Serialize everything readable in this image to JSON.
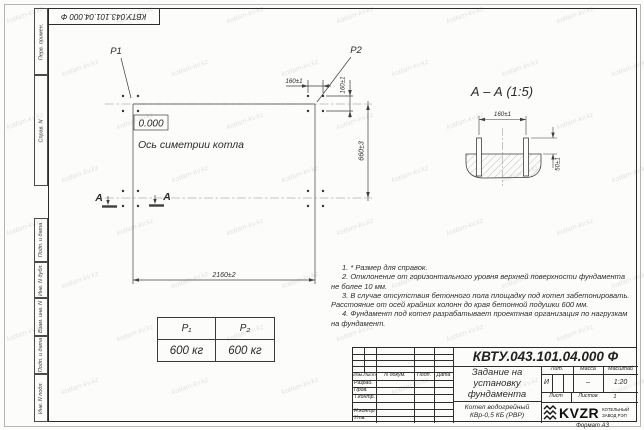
{
  "watermark": "kotlam-kv.kz",
  "corner_stamp": {
    "doc_number": "КВТУ.043.101.04.000  Ф"
  },
  "sidebar": {
    "labels": [
      "Перв. примен.",
      "Справ. N",
      "Подп. и дата",
      "Инв. N дубл.",
      "Взам. инв. N",
      "Подп. и дата",
      "Инв. N подл."
    ]
  },
  "plan": {
    "p1": "P1",
    "p2": "P2",
    "level": "0.000",
    "axis_label": "Ось симетрии котла",
    "dim_width": "2160±2",
    "dim_height": "660±3",
    "dim_spacing_h": "160±1",
    "dim_spacing_v": "160±1",
    "section_letter_left": "А",
    "section_letter_right": "А"
  },
  "section_view": {
    "title": "А – А (1:5)",
    "dim_spacing": "160±1",
    "dim_height": "50±1"
  },
  "load_table": {
    "col1_header": "P₁",
    "col2_header": "P₂",
    "col1_value": "600 кг",
    "col2_value": "600 кг"
  },
  "notes": {
    "items": [
      "1. * Размер для справок.",
      "2. Отклонение от горизонтального уровня верхней поверхности фундамента не более 10 мм.",
      "3. В случае отсутствия бетонного пола площадку под котел забетонировать. Расстояние от осей крайних колонн до края бетонной подушки 600 мм.",
      "4. Фундамент под котел разрабатывает проектная организация по нагрузкам на фундамент."
    ]
  },
  "title_block": {
    "doc_number": "КВТУ.043.101.04.000  Ф",
    "title_line1": "Задание на",
    "title_line2": "установку",
    "title_line3": "фундамента",
    "product_line1": "Котел водогрейный",
    "product_line2": "КВр-0,5 КБ (РВР)",
    "col_izm": "Изм.Лист",
    "col_doc": "N докум.",
    "col_sign": "Подп.",
    "col_date": "Дата",
    "row_razrab": "Разраб.",
    "row_prov": "Пров.",
    "row_tkontr": "Т.контр.",
    "row_nkontr": "Н.контр.",
    "row_utv": "Утв.",
    "lit_header": "Лит.",
    "mass_header": "Масса",
    "scale_header": "Масштаб",
    "lit_value": "И",
    "mass_value": "–",
    "scale_value": "1:20",
    "sheet_label": "Лист",
    "sheets_label": "Листов",
    "sheets_value": "1",
    "logo_text": "KVZR",
    "logo_sub1": "КОТЕЛЬНЫЙ",
    "logo_sub2": "ЗАВОД РЭП",
    "format_label": "Формат А3"
  }
}
